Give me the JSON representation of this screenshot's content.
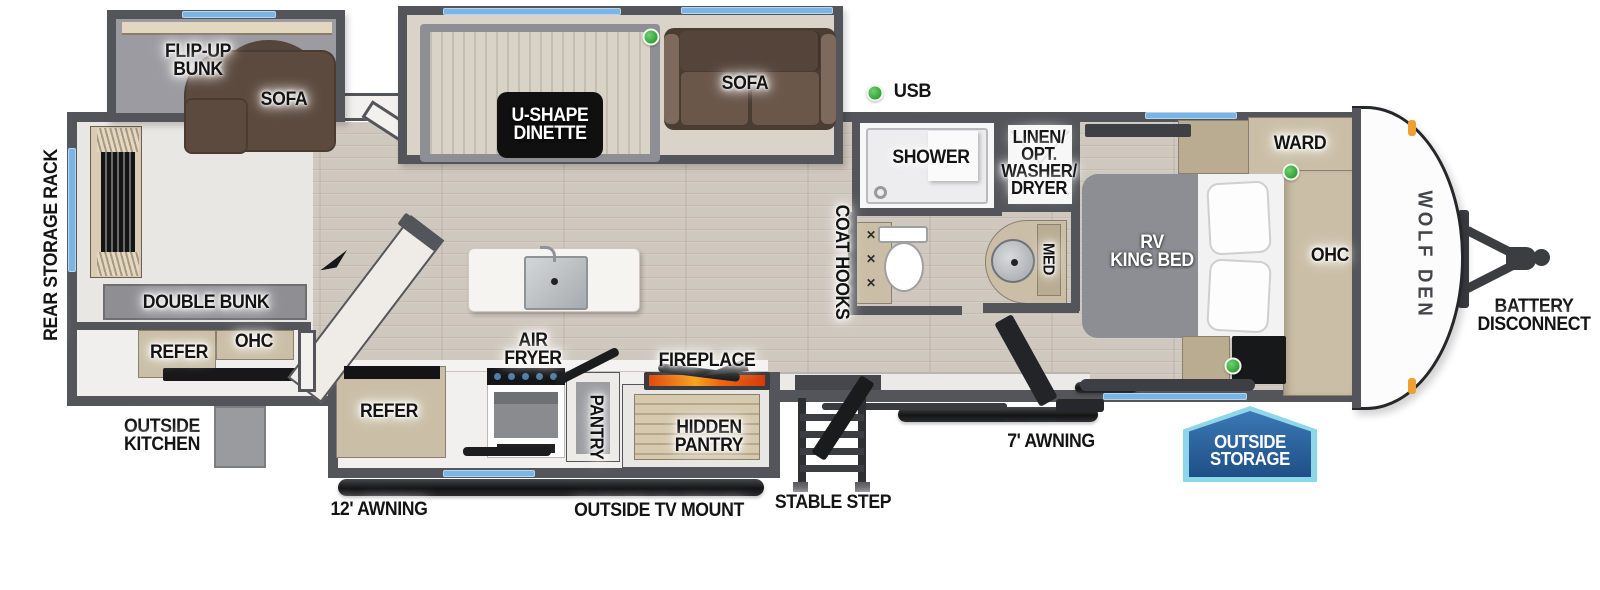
{
  "brand": {
    "logo": "WOLF DEN"
  },
  "labels": {
    "rear_storage_rack": "REAR STORAGE RACK",
    "flip_up_bunk": "FLIP-UP\nBUNK",
    "bunk_sofa": "SOFA",
    "u_shape_dinette": "U-SHAPE\nDINETTE",
    "living_sofa": "SOFA",
    "usb": "USB",
    "shower": "SHOWER",
    "linen_opt_washer_dryer": "LINEN/\nOPT.\nWASHER/\nDRYER",
    "coat_hooks": "COAT HOOKS",
    "med": "MED",
    "ward": "WARD",
    "rv_king_bed": "RV\nKING BED",
    "bedroom_ohc": "OHC",
    "double_bunk": "DOUBLE BUNK",
    "rear_refer": "REFER",
    "rear_ohc": "OHC",
    "outside_kitchen": "OUTSIDE\nKITCHEN",
    "kitchen_refer": "REFER",
    "air_fryer": "AIR\nFRYER",
    "pantry": "PANTRY",
    "fireplace": "FIREPLACE",
    "hidden_pantry": "HIDDEN\nPANTRY",
    "awning_12": "12' AWNING",
    "outside_tv_mount": "OUTSIDE TV MOUNT",
    "stable_step": "STABLE STEP",
    "awning_7": "7' AWNING",
    "outside_storage": "OUTSIDE\nSTORAGE",
    "battery_disconnect": "BATTERY\nDISCONNECT"
  },
  "colors": {
    "wall": "#54555a",
    "window": "#7ab5e3",
    "usb_dot_green": "#2f9e33",
    "badge_blue": "#2d6aab",
    "badge_border": "#8ed6ea",
    "marker_orange": "#f0a030",
    "floor_wood": "#cfc8be",
    "cabinet_beige": "#cabfa6",
    "sofa_brown": "#5c4a3e"
  }
}
